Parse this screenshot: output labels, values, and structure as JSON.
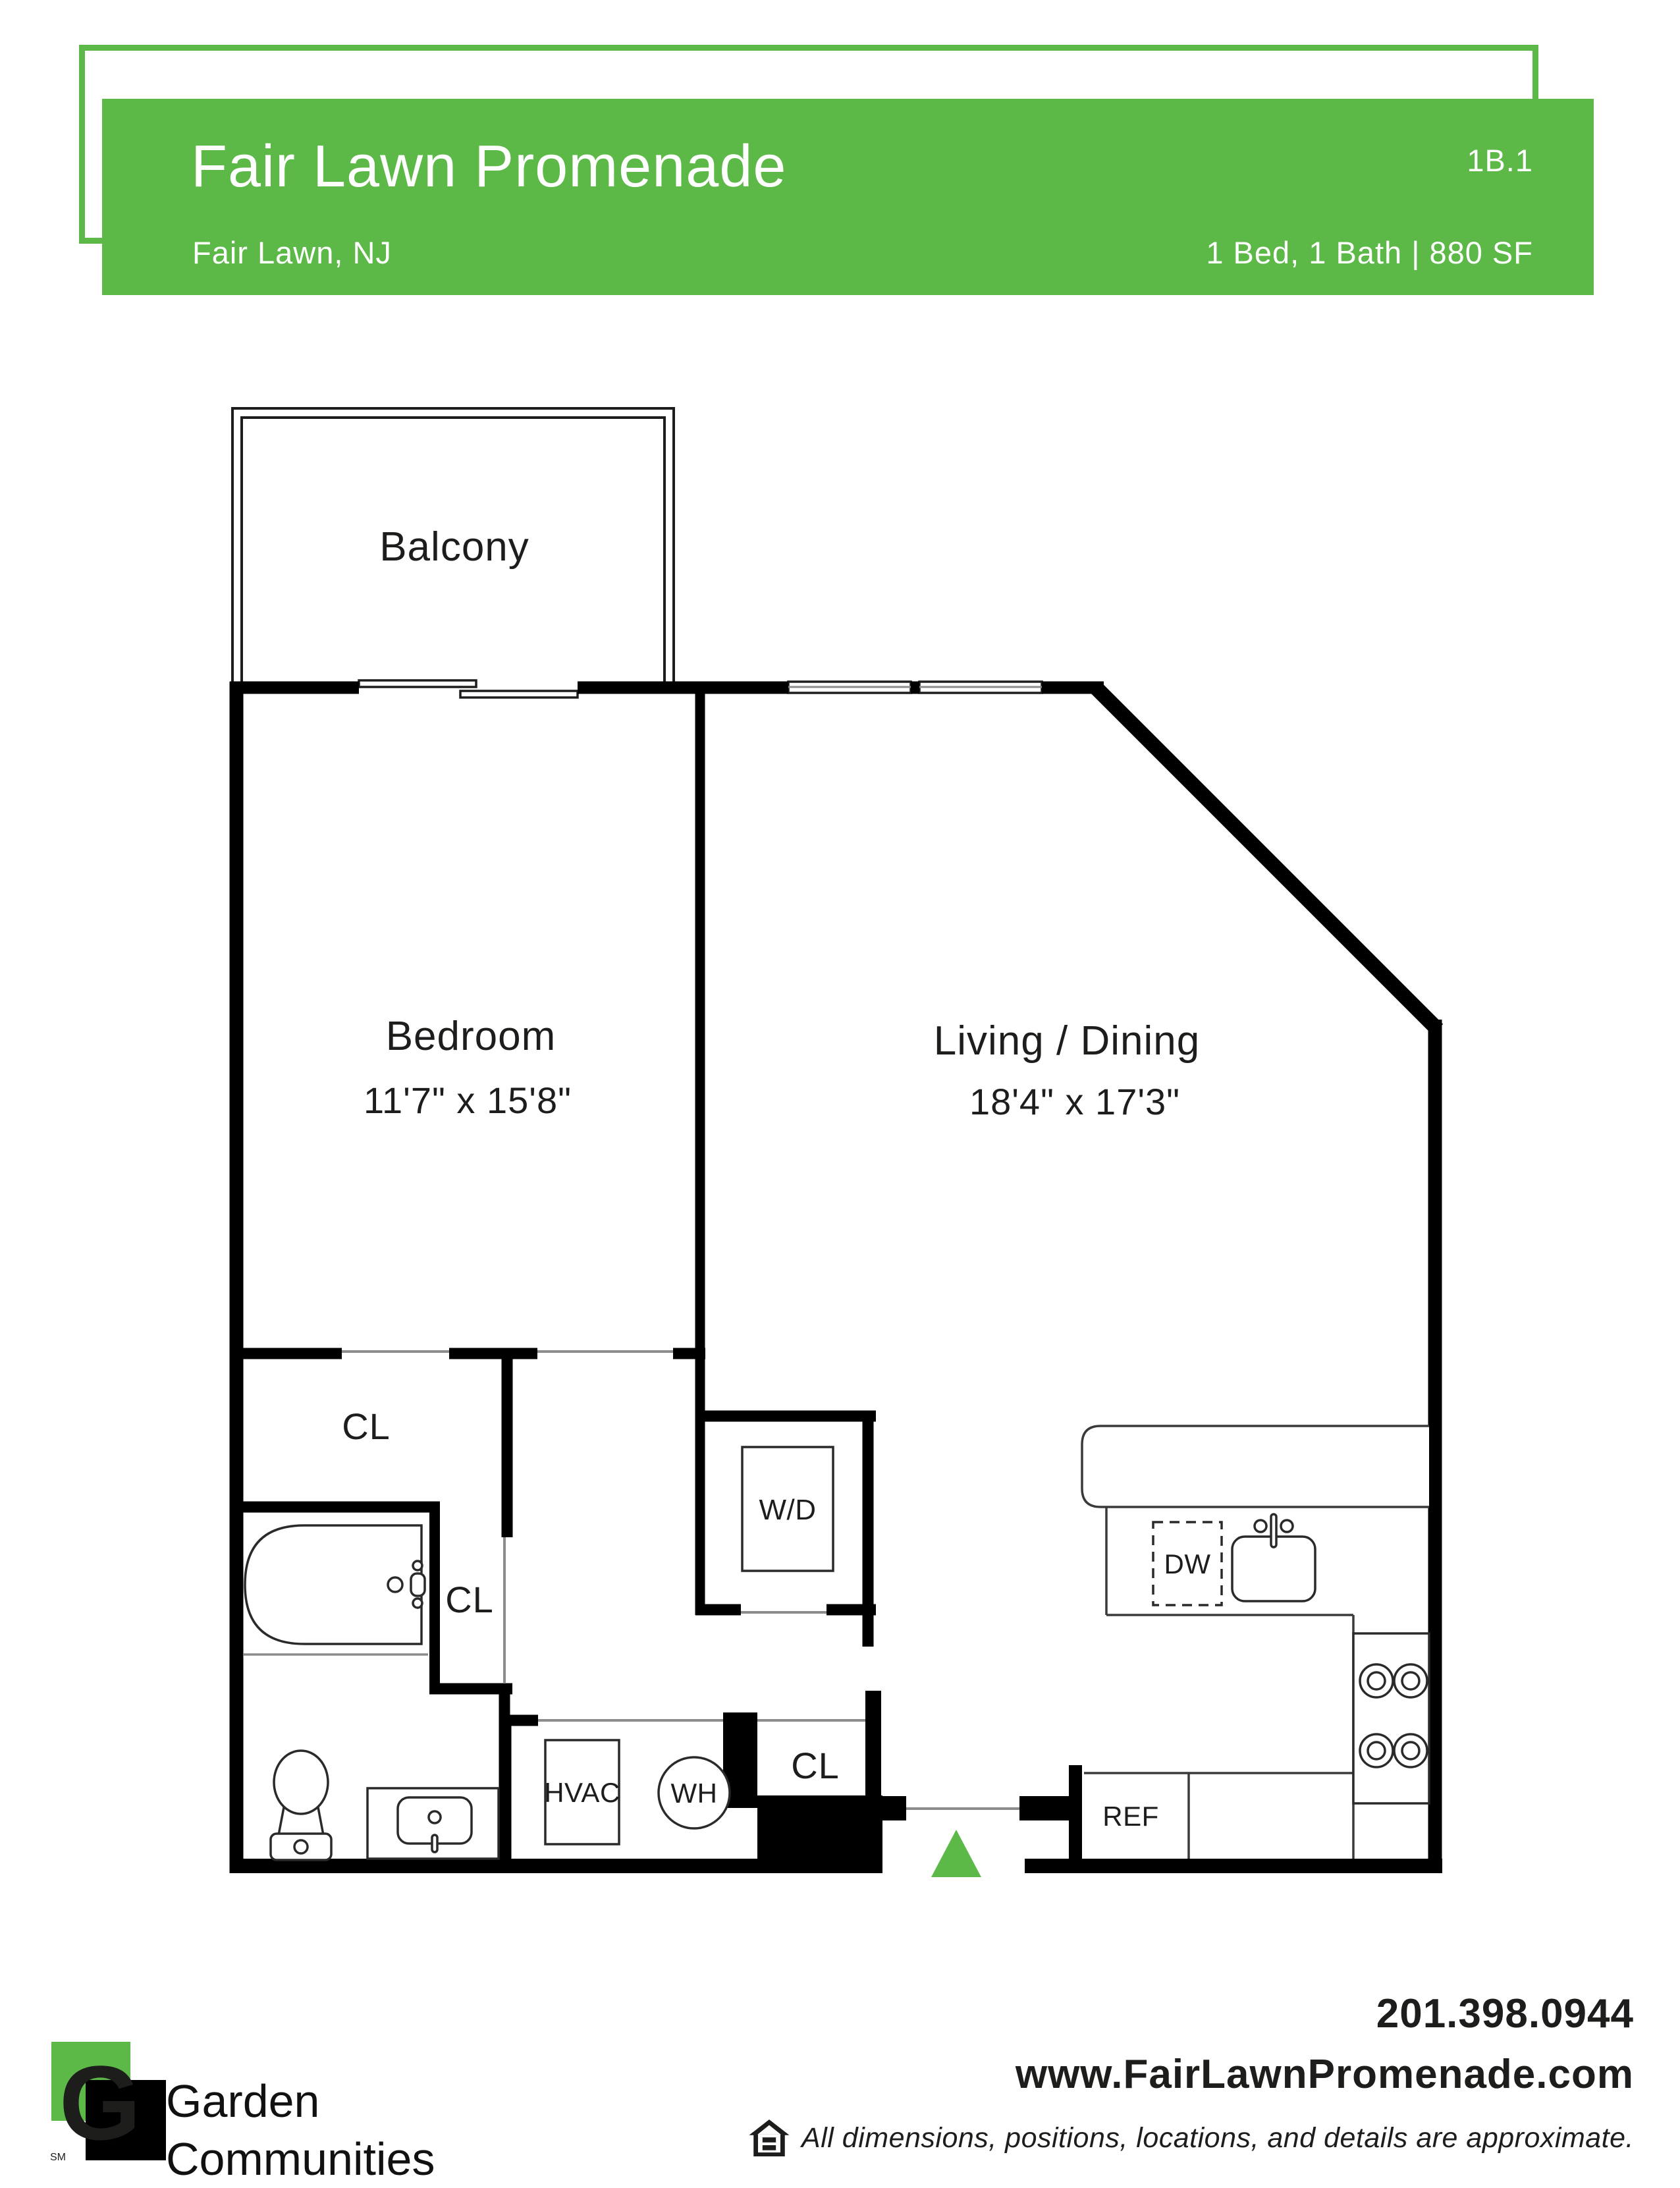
{
  "header": {
    "property_name": "Fair Lawn Promenade",
    "location": "Fair Lawn, NJ",
    "unit_code": "1B.1",
    "unit_specs": "1 Bed, 1 Bath | 880 SF",
    "accent_color": "#5cb947"
  },
  "floorplan": {
    "balcony_label": "Balcony",
    "bedroom": {
      "name": "Bedroom",
      "dims": "11'7\" x 15'8\""
    },
    "living_dining": {
      "name": "Living / Dining",
      "dims": "18'4\" x 17'3\""
    },
    "closets": {
      "bedroom_closet": "CL",
      "linen_closet": "CL",
      "entry_closet": "CL"
    },
    "appliances": {
      "washer_dryer": "W/D",
      "hvac": "HVAC",
      "water_heater": "WH",
      "dishwasher": "DW",
      "refrigerator": "REF"
    }
  },
  "footer": {
    "logo_initial": "G",
    "logo_service_mark": "SM",
    "brand_line1": "Garden",
    "brand_line2": "Communities",
    "phone": "201.398.0944",
    "website": "www.FairLawnPromenade.com",
    "disclaimer": "All dimensions, positions, locations, and details are approximate."
  }
}
